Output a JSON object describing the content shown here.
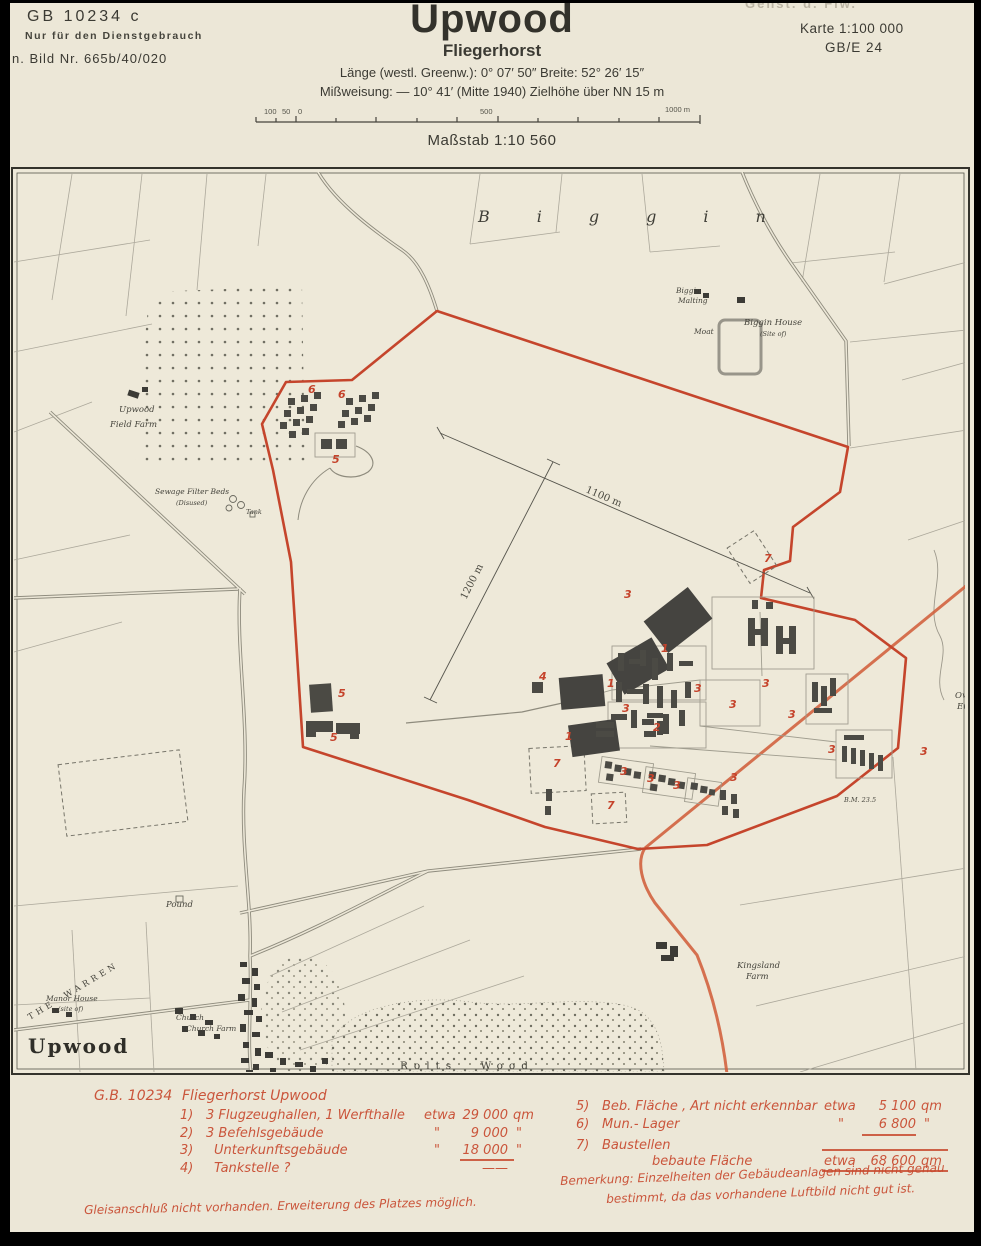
{
  "colors": {
    "paper": "#ece7d7",
    "boundary_red": "#c5452c",
    "road_orange": "#d05a36",
    "building_gray": "#4b4a44",
    "legend_red": "#c8492e"
  },
  "header": {
    "ref_left": {
      "line1": "GB 10234 c",
      "line2": "Nur für den Dienstgebrauch",
      "line3": "n. Bild Nr. 665b/40/020"
    },
    "title": "Upwood",
    "subtitle": "Fliegerhorst",
    "coords_line": "Länge (westl. Greenw.): 0° 07′ 50″   Breite: 52° 26′ 15″",
    "declination_line": "Mißweisung: — 10° 41′  (Mitte 1940)  Zielhöhe über NN 15 m",
    "scale_caption": "Maßstab 1:10 560",
    "scalebar": {
      "l100": "100",
      "l50": "50",
      "l0": "0",
      "l500": "500",
      "l1000": "1000 m"
    },
    "ref_right": {
      "faded": "Genst. d. Flw.",
      "line1": "Karte 1:100 000",
      "line2": "GB/E 24"
    }
  },
  "map": {
    "dimension_labels": {
      "dim1": "1100 m",
      "dim2": "1200 m"
    },
    "labels": {
      "biggin": "Biggin",
      "upwood_village": "Upwood",
      "rolts_wood": "Rolts Wood",
      "the_warren": "THE WARREN",
      "kingsland1": "Kingsland",
      "kingsland2": "Farm",
      "upwood_field1": "Upwood",
      "upwood_field2": "Field Farm",
      "sewage1": "Sewage Filter Beds",
      "sewage2": "(Disused)",
      "tank": "Tank",
      "biggin_malting1": "Biggin",
      "biggin_malting2": "Malting",
      "biggin_house1": "Biggin House",
      "biggin_house2": "(Site of)",
      "moat": "Moat",
      "manor1": "Manor House",
      "manor2": "(site of)",
      "church": "Church",
      "church_farm": "Church Farm",
      "pound": "Pound",
      "owl1": "Owl",
      "owl2": "End",
      "bm": "B.M. 23.5"
    },
    "markers": [
      {
        "n": "1",
        "x": 661,
        "y": 652
      },
      {
        "n": "1",
        "x": 607,
        "y": 687
      },
      {
        "n": "1",
        "x": 565,
        "y": 740
      },
      {
        "n": "2",
        "x": 653,
        "y": 731
      },
      {
        "n": "3",
        "x": 624,
        "y": 598
      },
      {
        "n": "3",
        "x": 622,
        "y": 712
      },
      {
        "n": "3",
        "x": 694,
        "y": 692
      },
      {
        "n": "3",
        "x": 729,
        "y": 708
      },
      {
        "n": "3",
        "x": 762,
        "y": 687
      },
      {
        "n": "3",
        "x": 788,
        "y": 718
      },
      {
        "n": "3",
        "x": 828,
        "y": 753
      },
      {
        "n": "3",
        "x": 920,
        "y": 755
      },
      {
        "n": "3",
        "x": 620,
        "y": 775
      },
      {
        "n": "3",
        "x": 647,
        "y": 782
      },
      {
        "n": "3",
        "x": 673,
        "y": 789
      },
      {
        "n": "3",
        "x": 730,
        "y": 781
      },
      {
        "n": "4",
        "x": 539,
        "y": 680
      },
      {
        "n": "5",
        "x": 338,
        "y": 697
      },
      {
        "n": "5",
        "x": 330,
        "y": 741
      },
      {
        "n": "5",
        "x": 332,
        "y": 463
      },
      {
        "n": "6",
        "x": 308,
        "y": 393
      },
      {
        "n": "6",
        "x": 338,
        "y": 398
      },
      {
        "n": "7",
        "x": 553,
        "y": 767
      },
      {
        "n": "7",
        "x": 607,
        "y": 809
      },
      {
        "n": "7",
        "x": 764,
        "y": 562
      }
    ]
  },
  "legend": {
    "gb_number": "G.B. 10234",
    "title": "Fliegerhorst Upwood",
    "items": [
      {
        "no": "1)",
        "text": "3 Flugzeughallen, 1 Werfthalle",
        "approx": "etwa",
        "value": "29 000",
        "unit": "qm"
      },
      {
        "no": "2)",
        "text": "3 Befehlsgebäude",
        "approx": "\"",
        "value": "9 000",
        "unit": "\""
      },
      {
        "no": "3)",
        "text": "Unterkunftsgebäude",
        "approx": "\"",
        "value": "18 000",
        "unit": "\""
      },
      {
        "no": "4)",
        "text": "Tankstelle ?",
        "approx": "",
        "value": "——",
        "unit": ""
      },
      {
        "no": "5)",
        "text": "Beb. Fläche , Art nicht erkennbar",
        "approx": "etwa",
        "value": "5 100",
        "unit": "qm"
      },
      {
        "no": "6)",
        "text": "Mun.- Lager",
        "approx": "\"",
        "value": "6 800",
        "unit": "\""
      },
      {
        "no": "7)",
        "text": "Baustellen",
        "approx": "",
        "value": "",
        "unit": ""
      }
    ],
    "total": {
      "label": "bebaute Fläche",
      "approx": "etwa",
      "value": "68 600",
      "unit": "qm"
    },
    "remark1": "Bemerkung:  Einzelheiten der Gebäudeanlagen sind nicht genau",
    "remark2": "bestimmt, da das vorhandene Luftbild nicht gut ist.",
    "footer": "Gleisanschluß nicht vorhanden.   Erweiterung des Platzes möglich."
  }
}
